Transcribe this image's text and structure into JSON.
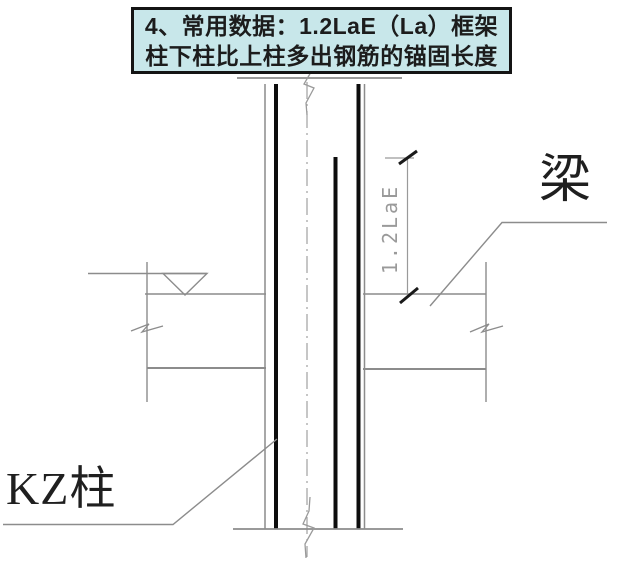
{
  "title_box": {
    "line1": "4、常用数据：1.2LaE（La）框架",
    "line2": "柱下柱比上柱多出钢筋的锚固长度"
  },
  "drawing": {
    "beam_label": "梁",
    "column_label": "KZ柱",
    "dimension_label": "1.2LaE",
    "symbols": {
      "level_marker": "open-down-triangle",
      "break_marks": "zigzag-cut-lines"
    },
    "colors": {
      "page_background": "#ffffff",
      "title_background": "#c8e7ea",
      "title_border": "#141414",
      "title_text": "#1c1c1c",
      "thin_line_gray": "#8c8c8c",
      "centerline_gray": "#9a9a9a",
      "rebar_black": "#0d0d0d",
      "dimension_text_gray": "#9a9a9a",
      "label_text": "#1f1f1f"
    }
  }
}
